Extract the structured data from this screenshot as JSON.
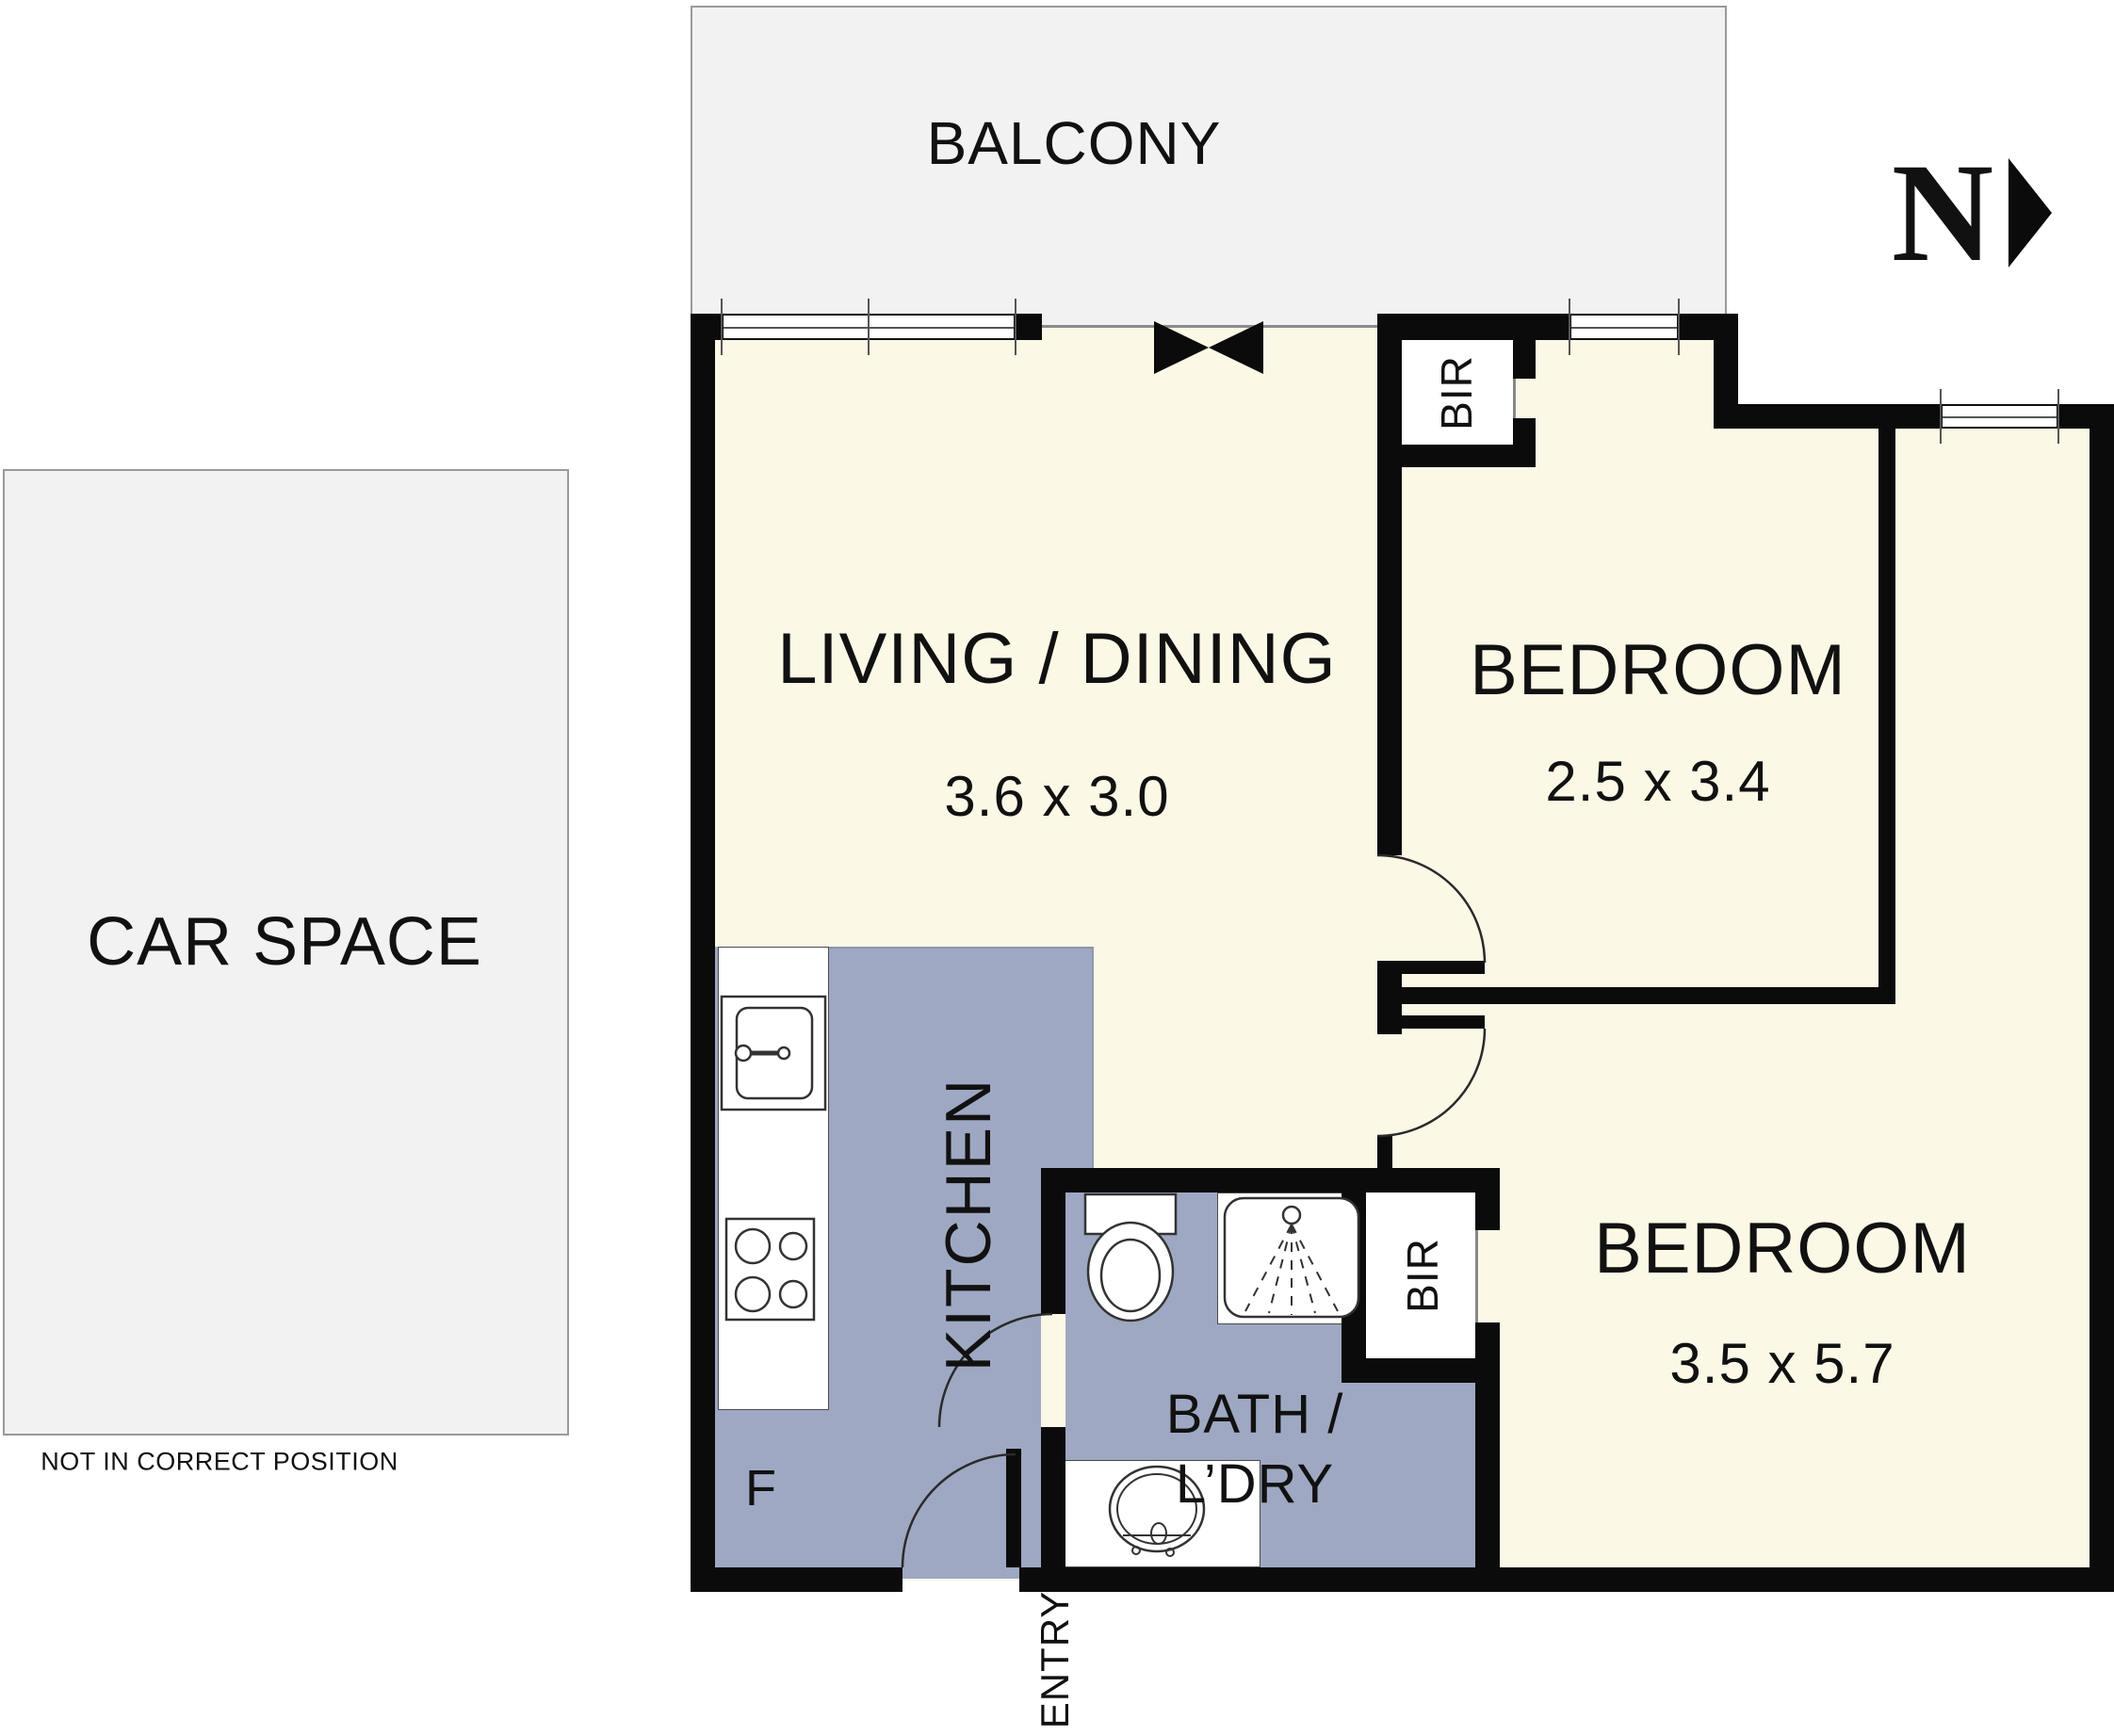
{
  "title": "Apartment floor plan",
  "colors": {
    "wall": "#0b0b0b",
    "floor": "#FCF8E6",
    "wet_area": "#9EA8C2",
    "outdoor": "#F1F2F1",
    "linework": "#333333"
  },
  "north": {
    "label": "N"
  },
  "balcony": {
    "label": "BALCONY"
  },
  "car_space": {
    "label": "CAR SPACE",
    "note": "NOT IN CORRECT POSITION"
  },
  "rooms": {
    "living": {
      "name": "LIVING / DINING",
      "dims": "3.6 x 3.0"
    },
    "bedroom1": {
      "name": "BEDROOM",
      "dims": "2.5 x 3.4",
      "robe": "BIR"
    },
    "bedroom2": {
      "name": "BEDROOM",
      "dims": "3.5 x 5.7",
      "robe": "BIR"
    },
    "kitchen": {
      "name": "KITCHEN",
      "fridge": "F"
    },
    "bath": {
      "line1": "BATH /",
      "line2": "L’DRY"
    },
    "entry": {
      "label": "ENTRY"
    }
  }
}
